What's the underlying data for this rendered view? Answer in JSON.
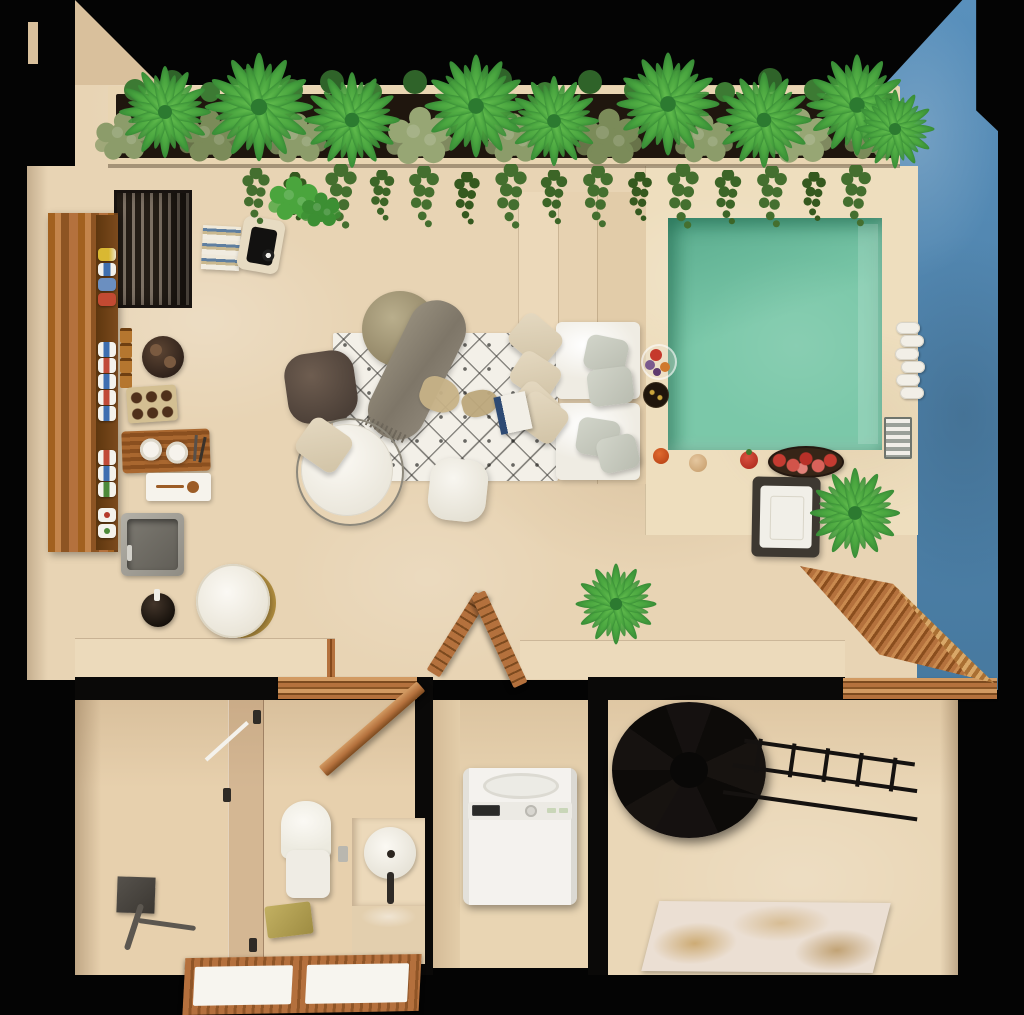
{
  "scene": {
    "title": "3D top-down floor plan render of a studio apartment with rooftop terrace and plunge pool",
    "view": "top-down axonometric",
    "visible_text": "none"
  },
  "palette": {
    "bg": "#040404",
    "floor": "#e8d4b4",
    "wallshade": "#d9c09c",
    "counter": "#ecdabb",
    "deck": "#eedebe",
    "planterframe": "#e9d5b2",
    "soil": "#1f160e",
    "pool": "#7bc8a9",
    "pooldeep": "#59ab8d",
    "blue": "#5990bc",
    "bluedark": "#47799f",
    "wood": "#b4713d",
    "wooddark": "#85491c",
    "woodlight": "#d29a62",
    "grill": "#241d16",
    "grillslat": "#7d7164",
    "white": "#f5f2eb",
    "sage": "#c7cabf",
    "beige": "#ddd0b5",
    "rugbase": "#f3f0e8",
    "rugline": "#34322e",
    "brown": "#594c42",
    "olive": "#a89d7b",
    "blanket": "#8b8475",
    "black": "#0a0908",
    "stair": "#151210",
    "gold": "#b3a155",
    "red": "#c23b2e",
    "mattan": "#ebdfd3",
    "matgold": "#c39a55",
    "towel": "#f2efe7",
    "palmgreen": "#57b447",
    "palmdark": "#2f8133",
    "bushsage": "#8c9c6a",
    "vine": "#446f2f",
    "glasstint": "rgba(170,125,90,0.30)"
  },
  "labels": {
    "scene": "Apartment floor plan",
    "terrace": "Terrace living area",
    "pool": "Plunge pool",
    "poolDeck": "Pool deck",
    "blueWall": "Blue accent wall",
    "planter": "Rooftop planter with palms and shrubs",
    "vines": "Hanging vines",
    "grill": "Built-in grill",
    "barShelf": "Wooden bar shelf with bottles and cans",
    "spiceJars": "Spice jars",
    "roundTray": "Round serving tray with cups",
    "crate": "Bottle crate",
    "rack": "Wooden drying rack with cups",
    "whiteTray": "Tray with wooden spoon",
    "sink": "Outdoor kitchen sink",
    "soapPot": "Soap dispenser pot",
    "sideTable": "Round side table",
    "books": "Stack of books",
    "basket": "Basket with record player",
    "steps": "Stepped bench platform",
    "sofa": "Outdoor sofa with cushions",
    "sagePillow": "Sage throw pillow",
    "beigePillow": "Beige throw pillow",
    "rug": "Diamond-pattern rug",
    "pouf": "Pouf with fringed throw",
    "blanket": "Fringed throw blanket",
    "brownChair": "Brown lounge cushion",
    "eggChair": "Wire-frame egg chair",
    "whitePouf": "White ottoman",
    "rugBook": "Book on rug",
    "paperPiece": "Paper piece on rug",
    "fruitBowlGlass": "Glass fruit bowl",
    "snackBowl": "Snack bowl",
    "fruit": "Fruit",
    "appleBowl": "Wooden bowl with apples",
    "towelRolls": "Rolled pool towels",
    "towelStack": "Folded striped towels",
    "lounger": "Pool lounger",
    "palm": "Palm plant",
    "bush": "Shrub",
    "bathroom": "Bathroom",
    "shower": "Walk-in shower",
    "showerSet": "Shower fixture",
    "glass": "Glass shower partition",
    "toilet": "Toilet",
    "flushPlate": "Flush plate",
    "goldTowel": "Folded gold towel",
    "sinkCounter": "Vanity counter",
    "vesselSink": "Round vessel sink",
    "faucet": "Faucet",
    "mirror": "Mirror reflection",
    "duckboard": "Wooden duckboard floor mats",
    "laundry": "Laundry closet",
    "washer": "Top-load washing machine",
    "bedroom": "Staircase room",
    "spiralStairs": "Spiral staircase",
    "railing": "Stair railing",
    "bedMat": "Floor mat with gold pattern",
    "doorBath": "Open bathroom door",
    "doorCloset": "Open closet doors",
    "doorBed": "Open room door",
    "threshold": "Wooden door threshold",
    "wall": "Wall",
    "pottedPlant": "Potted plant"
  }
}
